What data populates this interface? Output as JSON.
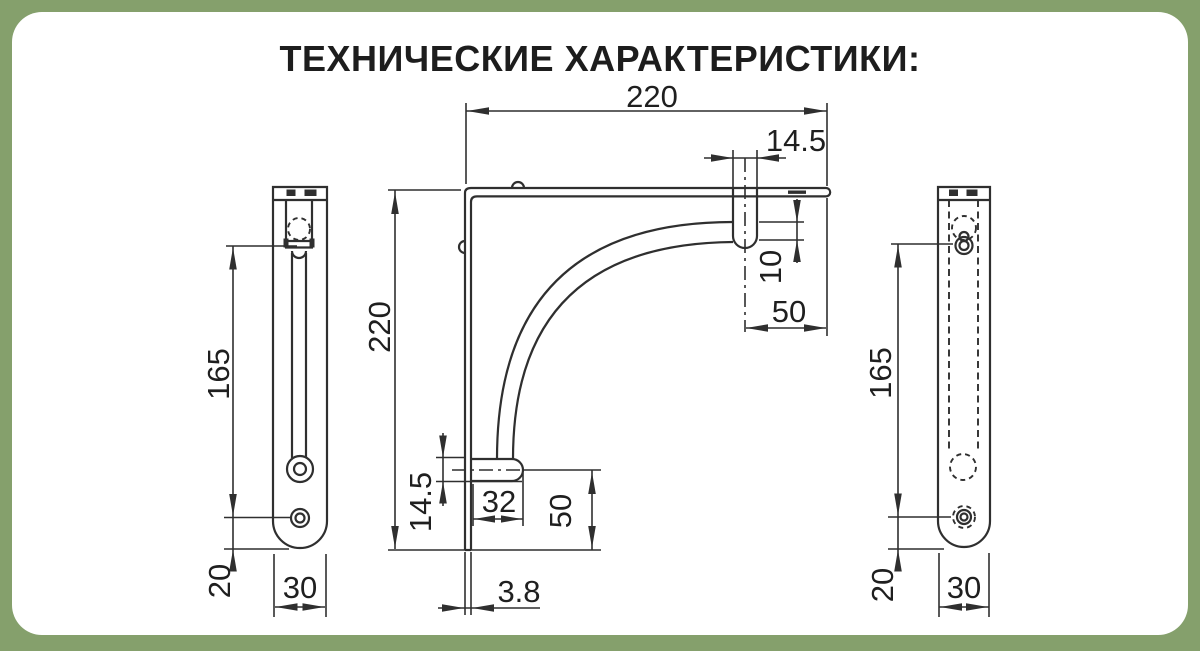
{
  "title": "ТЕХНИЧЕСКИЕ ХАРАКТЕРИСТИКИ:",
  "colors": {
    "background": "#85A06C",
    "card": "#FFFFFF",
    "line": "#2F2F2F",
    "text": "#1D1D1D"
  },
  "views": {
    "left_side": {
      "dims": {
        "hook_to_hole": "165",
        "hole_to_bottom": "20",
        "width": "30"
      }
    },
    "front": {
      "dims": {
        "arm_length": "220",
        "top_tab_width": "14.5",
        "tab_drop": "10",
        "tab_center_to_end": "50",
        "plate_height": "220",
        "bottom_tab_height": "14.5",
        "bottom_tab_length": "32",
        "tab_center_to_base": "50",
        "metal_thickness": "3.8"
      }
    },
    "right_side": {
      "dims": {
        "hook_to_hole": "165",
        "hole_to_bottom": "20",
        "width": "30"
      }
    }
  }
}
